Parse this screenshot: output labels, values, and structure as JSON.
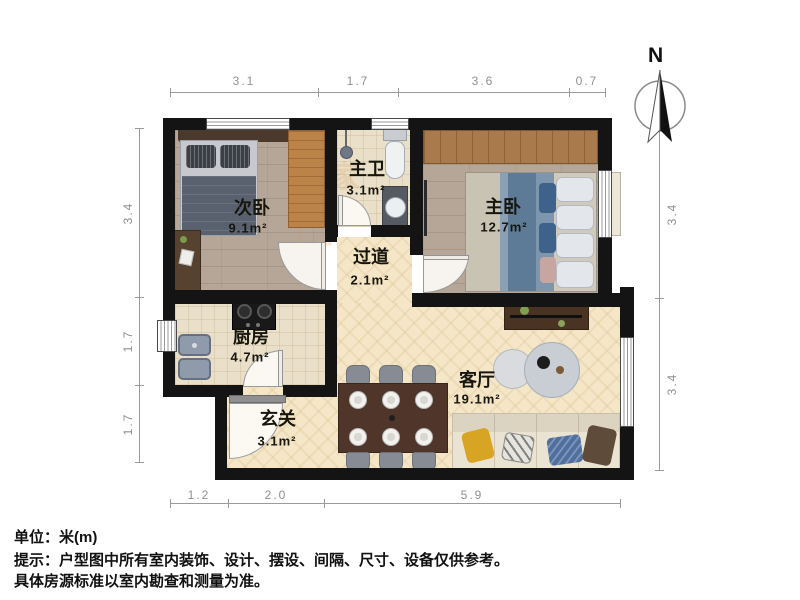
{
  "rooms": {
    "second_bedroom": {
      "name": "次卧",
      "area": "9.1m²"
    },
    "master_bath": {
      "name": "主卫",
      "area": "3.1m²"
    },
    "master_bedroom": {
      "name": "主卧",
      "area": "12.7m²"
    },
    "hallway": {
      "name": "过道",
      "area": "2.1m²"
    },
    "kitchen": {
      "name": "厨房",
      "area": "4.7m²"
    },
    "entry": {
      "name": "玄关",
      "area": "3.1m²"
    },
    "living_room": {
      "name": "客厅",
      "area": "19.1m²"
    }
  },
  "dimensions": {
    "top": [
      {
        "label": "3.1"
      },
      {
        "label": "1.7"
      },
      {
        "label": "3.6"
      },
      {
        "label": "0.7"
      }
    ],
    "left": [
      {
        "label": "3.4"
      },
      {
        "label": "1.7"
      },
      {
        "label": "1.7"
      }
    ],
    "right": [
      {
        "label": "3.4"
      },
      {
        "label": "3.4"
      }
    ],
    "bottom": [
      {
        "label": "1.2"
      },
      {
        "label": "2.0"
      },
      {
        "label": "5.9"
      }
    ]
  },
  "compass": {
    "label": "N"
  },
  "watermark": {
    "char": "家"
  },
  "footer": {
    "unit": "单位：米(m)",
    "tip_line1": "提示：户型图中所有室内装饰、设计、摆设、间隔、尺寸、设备仅供参考。",
    "tip_line2": "具体房源标准以室内勘查和测量为准。"
  },
  "colors": {
    "wall": "#141414",
    "floor_wood": "#b5a697",
    "floor_tile": "#eae0c9",
    "floor_herringbone": "#f4e6c6",
    "dimension_gray": "#9b9b9b"
  }
}
